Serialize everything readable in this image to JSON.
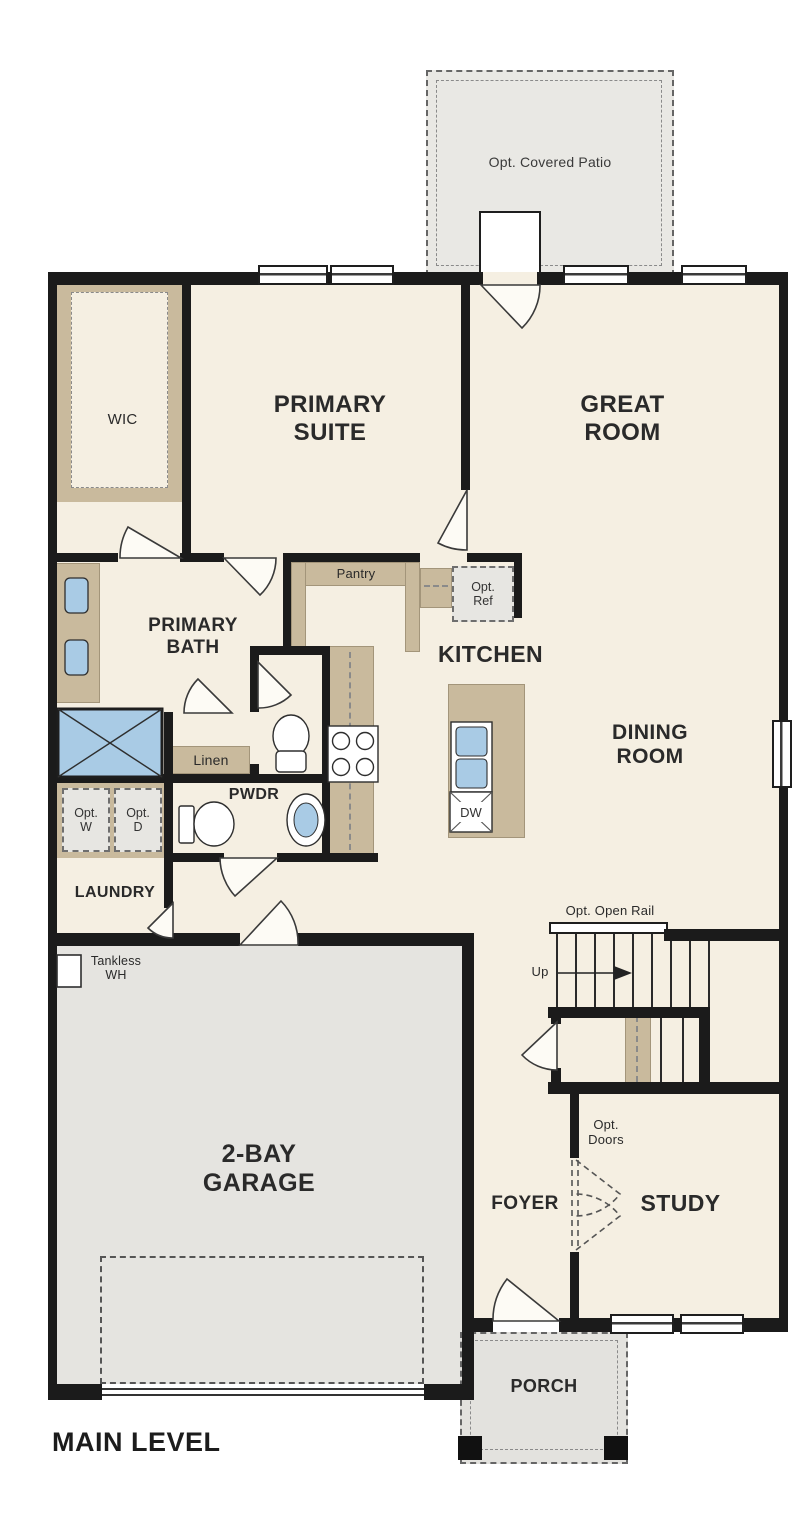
{
  "title": "MAIN LEVEL",
  "colors": {
    "wall": "#1b1b1b",
    "floor": "#f5efe2",
    "counter_tan": "#c9ba9d",
    "garage_gray": "#e5e4e0",
    "patio_gray": "#e9e8e4",
    "option_fill": "#e7e6e2",
    "fixture_blue": "#a9cbe5"
  },
  "rooms": {
    "patio": {
      "label": "Opt. Covered Patio"
    },
    "wic": {
      "label": "WIC"
    },
    "primary_suite": {
      "label": "PRIMARY SUITE"
    },
    "great_room": {
      "label": "GREAT ROOM"
    },
    "primary_bath": {
      "label": "PRIMARY BATH"
    },
    "pantry": {
      "label": "Pantry"
    },
    "kitchen": {
      "label": "KITCHEN"
    },
    "dining_room": {
      "label": "DINING ROOM"
    },
    "linen": {
      "label": "Linen"
    },
    "powder": {
      "label": "PWDR"
    },
    "laundry": {
      "label": "LAUNDRY"
    },
    "garage": {
      "label": "2-BAY GARAGE"
    },
    "foyer": {
      "label": "FOYER"
    },
    "study": {
      "label": "STUDY"
    },
    "porch": {
      "label": "PORCH"
    }
  },
  "annotations": {
    "opt_ref": "Opt. Ref",
    "opt_washer": "Opt. W",
    "opt_dryer": "Opt. D",
    "opt_open_rail": "Opt. Open Rail",
    "opt_doors": "Opt. Doors",
    "up": "Up",
    "tankless_wh": "Tankless WH",
    "dishwasher": "DW"
  }
}
